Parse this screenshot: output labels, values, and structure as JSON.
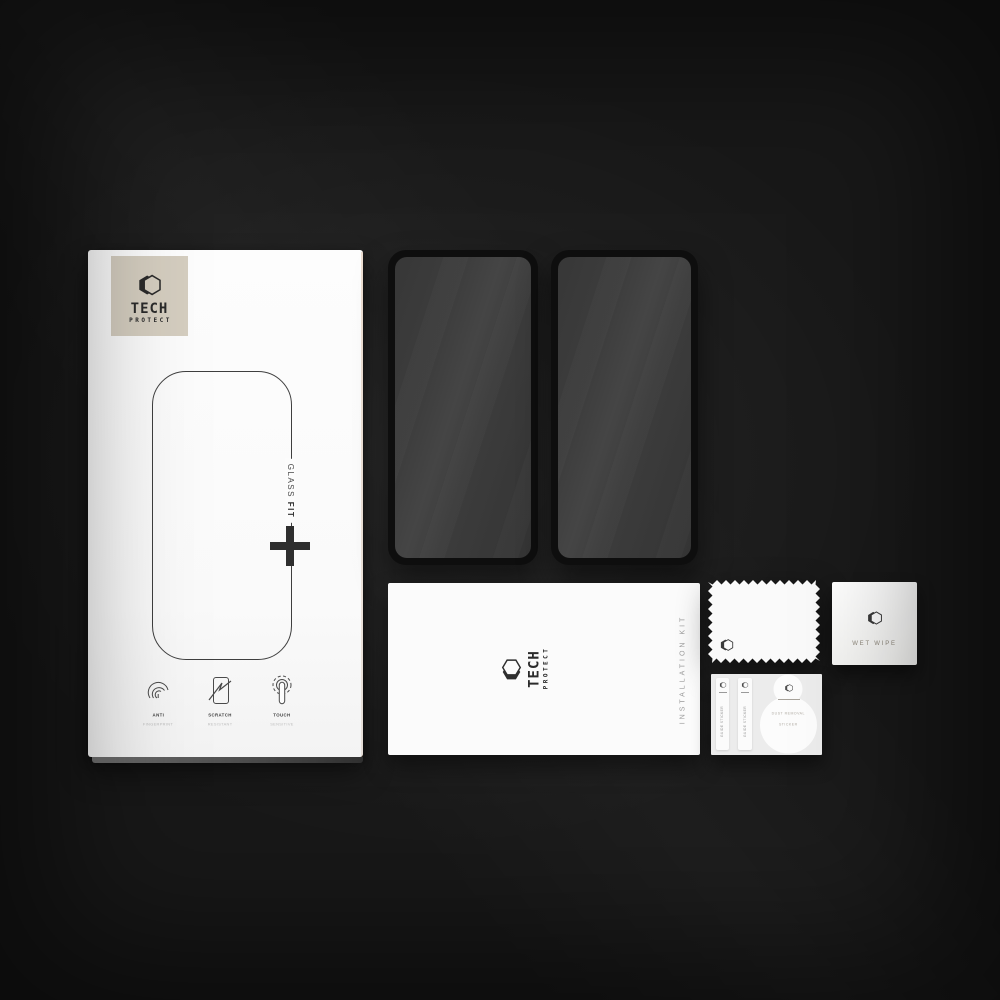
{
  "brand": {
    "name": "TECH",
    "subname": "PROTECT"
  },
  "box": {
    "glass_word": "GLASS",
    "fit_word": "FIT",
    "plus_icon": "+",
    "features": [
      {
        "icon": "fingerprint-icon",
        "title": "ANTI",
        "subtitle": "FINGERPRINT"
      },
      {
        "icon": "scratch-icon",
        "title": "SCRATCH",
        "subtitle": "RESISTANT"
      },
      {
        "icon": "touch-icon",
        "title": "TOUCH",
        "subtitle": "SENSITIVE"
      }
    ]
  },
  "kit_card": {
    "label": "INSTALLATION KIT"
  },
  "accessories": {
    "wet_wipe_label": "WET WIPE",
    "guide_sticker_1": "GUIDE STICKER",
    "guide_sticker_2": "GUIDE STICKER",
    "dust_removal_line1": "DUST REMOVAL",
    "dust_removal_line2": "STICKER"
  },
  "colors": {
    "background": "#181818",
    "box_white": "#fbfbfb",
    "logo_tile_beige": "#d5cec0",
    "glass_frame_black": "#0e0e0e",
    "glass_screen_gray": "#3d3d3d",
    "ink_dark": "#2e2e2e",
    "muted_gray": "#9b9b9b"
  }
}
